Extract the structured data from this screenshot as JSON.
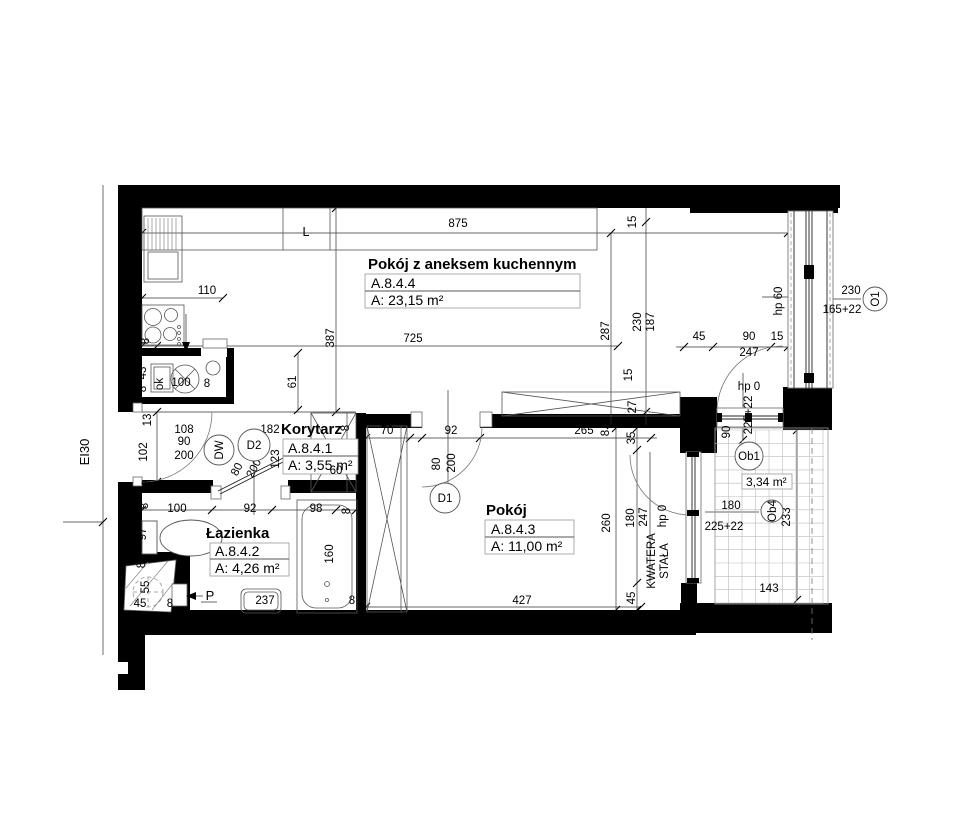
{
  "rooms": [
    {
      "name": "Pokój z aneksem kuchennym",
      "code": "A.8.4.4",
      "area": "A: 23,15 m²"
    },
    {
      "name": "Korytarz",
      "code": "A.8.4.1",
      "area": "A: 3,55 m²"
    },
    {
      "name": "Łazienka",
      "code": "A.8.4.2",
      "area": "A: 4,26 m²"
    },
    {
      "name": "Pokój",
      "code": "A.8.4.3",
      "area": "A: 11,00 m²"
    }
  ],
  "balcony": {
    "area": "3,34 m²"
  },
  "annotations": {
    "fire_rating": "EI30",
    "kitchen_letter": "L",
    "shaft_arrow": "P",
    "window_note_line1": "KWATERA",
    "window_note_line2": "STAŁA"
  },
  "markers": [
    {
      "label": "DW",
      "x": 219,
      "y": 450,
      "r": 15,
      "rot": -90
    },
    {
      "label": "D2",
      "x": 254,
      "y": 445,
      "r": 16,
      "rot": 0
    },
    {
      "label": "D1",
      "x": 445,
      "y": 498,
      "r": 15,
      "rot": 0
    },
    {
      "label": "O1",
      "x": 875,
      "y": 299,
      "r": 12,
      "rot": -90
    },
    {
      "label": "Ob1",
      "x": 749,
      "y": 456,
      "r": 14,
      "rot": 0
    },
    {
      "label": "Ob4",
      "x": 772,
      "y": 511,
      "r": 11,
      "rot": -90
    }
  ],
  "dimensions": [
    {
      "text": "875",
      "x": 458,
      "y": 227,
      "rot": 0
    },
    {
      "text": "203",
      "x": 141,
      "y": 270,
      "rot": -90
    },
    {
      "text": "110",
      "x": 207,
      "y": 294,
      "rot": 0
    },
    {
      "text": "8",
      "x": 149,
      "y": 341,
      "rot": -90
    },
    {
      "text": "387",
      "x": 334,
      "y": 338,
      "rot": -90
    },
    {
      "text": "61",
      "x": 296,
      "y": 382,
      "rot": -90
    },
    {
      "text": "725",
      "x": 413,
      "y": 342,
      "rot": 0
    },
    {
      "text": "287",
      "x": 609,
      "y": 331,
      "rot": -90
    },
    {
      "text": "15",
      "x": 636,
      "y": 222,
      "rot": -90
    },
    {
      "text": "230",
      "x": 641,
      "y": 322,
      "rot": -90
    },
    {
      "text": "187",
      "x": 654,
      "y": 322,
      "rot": -90
    },
    {
      "text": "15",
      "x": 632,
      "y": 375,
      "rot": -90
    },
    {
      "text": "45",
      "x": 699,
      "y": 340,
      "rot": 0
    },
    {
      "text": "90",
      "x": 749,
      "y": 340,
      "rot": 0
    },
    {
      "text": "15",
      "x": 777,
      "y": 340,
      "rot": 0
    },
    {
      "text": "247",
      "x": 749,
      "y": 356,
      "rot": 0
    },
    {
      "text": "hp 60",
      "x": 782,
      "y": 301,
      "rot": -90
    },
    {
      "text": "230",
      "x": 851,
      "y": 294,
      "rot": 0
    },
    {
      "text": "165+22",
      "x": 842,
      "y": 313,
      "rot": 0
    },
    {
      "text": "27",
      "x": 636,
      "y": 407,
      "rot": -90
    },
    {
      "text": "35",
      "x": 635,
      "y": 438,
      "rot": -90
    },
    {
      "text": "hp 0",
      "x": 749,
      "y": 390,
      "rot": 0
    },
    {
      "text": "90",
      "x": 730,
      "y": 432,
      "rot": -90
    },
    {
      "text": "225+22",
      "x": 752,
      "y": 415,
      "rot": -90
    },
    {
      "text": "43",
      "x": 146,
      "y": 373,
      "rot": -90
    },
    {
      "text": "8",
      "x": 146,
      "y": 389,
      "rot": -90
    },
    {
      "text": "ok",
      "x": 163,
      "y": 384,
      "rot": -90
    },
    {
      "text": "100",
      "x": 181,
      "y": 386,
      "rot": 0
    },
    {
      "text": "8",
      "x": 207,
      "y": 387,
      "rot": 0
    },
    {
      "text": "13",
      "x": 151,
      "y": 420,
      "rot": -90
    },
    {
      "text": "108",
      "x": 184,
      "y": 433,
      "rot": 0
    },
    {
      "text": "90",
      "x": 184,
      "y": 445,
      "rot": 0
    },
    {
      "text": "200",
      "x": 184,
      "y": 459,
      "rot": 0
    },
    {
      "text": "102",
      "x": 147,
      "y": 452,
      "rot": -90
    },
    {
      "text": "8",
      "x": 150,
      "y": 483,
      "rot": -90
    },
    {
      "text": "8",
      "x": 148,
      "y": 506,
      "rot": -90
    },
    {
      "text": "182",
      "x": 270,
      "y": 433,
      "rot": 0
    },
    {
      "text": "123",
      "x": 279,
      "y": 459,
      "rot": -90
    },
    {
      "text": "80",
      "x": 240,
      "y": 471,
      "rot": -62
    },
    {
      "text": "200",
      "x": 257,
      "y": 470,
      "rot": -62
    },
    {
      "text": "60",
      "x": 336,
      "y": 474,
      "rot": 0
    },
    {
      "text": "8",
      "x": 333,
      "y": 489,
      "rot": -90
    },
    {
      "text": "8",
      "x": 349,
      "y": 428,
      "rot": -90
    },
    {
      "text": "70",
      "x": 387,
      "y": 434,
      "rot": 0
    },
    {
      "text": "92",
      "x": 451,
      "y": 434,
      "rot": 0
    },
    {
      "text": "80",
      "x": 440,
      "y": 464,
      "rot": -90
    },
    {
      "text": "200",
      "x": 455,
      "y": 463,
      "rot": -90
    },
    {
      "text": "265",
      "x": 584,
      "y": 434,
      "rot": 0
    },
    {
      "text": "8",
      "x": 609,
      "y": 433,
      "rot": -90
    },
    {
      "text": "100",
      "x": 177,
      "y": 512,
      "rot": 0
    },
    {
      "text": "92",
      "x": 250,
      "y": 512,
      "rot": 0
    },
    {
      "text": "98",
      "x": 316,
      "y": 512,
      "rot": 0
    },
    {
      "text": "8",
      "x": 350,
      "y": 511,
      "rot": -90
    },
    {
      "text": "97",
      "x": 146,
      "y": 534,
      "rot": -90
    },
    {
      "text": "8",
      "x": 145,
      "y": 565,
      "rot": -90
    },
    {
      "text": "160",
      "x": 333,
      "y": 554,
      "rot": -90
    },
    {
      "text": "237",
      "x": 265,
      "y": 604,
      "rot": 0
    },
    {
      "text": "55",
      "x": 149,
      "y": 587,
      "rot": -90
    },
    {
      "text": "45",
      "x": 140,
      "y": 607,
      "rot": 0
    },
    {
      "text": "8",
      "x": 170,
      "y": 607,
      "rot": 0
    },
    {
      "text": "8",
      "x": 352,
      "y": 604,
      "rot": 0
    },
    {
      "text": "260",
      "x": 610,
      "y": 523,
      "rot": -90
    },
    {
      "text": "427",
      "x": 522,
      "y": 604,
      "rot": 0
    },
    {
      "text": "45",
      "x": 635,
      "y": 598,
      "rot": -90
    },
    {
      "text": "180",
      "x": 634,
      "y": 518,
      "rot": -90
    },
    {
      "text": "247",
      "x": 647,
      "y": 517,
      "rot": -90
    },
    {
      "text": "hp 0",
      "x": 666,
      "y": 516,
      "rot": -90
    },
    {
      "text": "180",
      "x": 731,
      "y": 509,
      "rot": 0
    },
    {
      "text": "225+22",
      "x": 724,
      "y": 530,
      "rot": 0
    },
    {
      "text": "233",
      "x": 790,
      "y": 517,
      "rot": -90
    },
    {
      "text": "143",
      "x": 769,
      "y": 592,
      "rot": 0
    }
  ]
}
